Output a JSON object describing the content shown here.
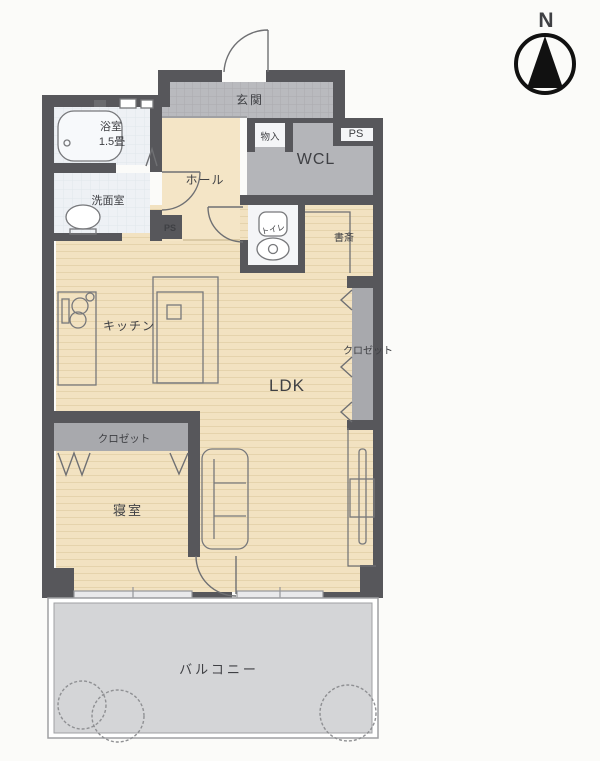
{
  "compass": {
    "label": "N"
  },
  "rooms": {
    "entrance": "玄関",
    "storage": "物入",
    "ps_top": "PS",
    "ps_mid": "PS",
    "wcl": "WCL",
    "hall": "ホール",
    "bathroom": "浴室",
    "bathroom_size": "1.5畳",
    "washroom": "洗面室",
    "toilet": "トイレ",
    "study": "書斎",
    "kitchen": "キッチン",
    "ldk": "LDK",
    "closet_ldk": "クロゼット",
    "closet_bedroom": "クロゼット",
    "bedroom": "寝室",
    "balcony": "バルコニー"
  },
  "colors": {
    "wall": "#57575b",
    "wood_floor": "#f2e2c1",
    "wood_plank_line": "#e5d3ac",
    "hall_floor": "#f4e5c6",
    "entrance_tile": "#b9babe",
    "wcl_floor": "#b4b5b9",
    "closet_floor": "#a8a9ad",
    "bath_floor": "#eef1f5",
    "white_room": "#f4f5f7",
    "balcony_floor": "#d4d5d7",
    "outline": "#6f7073",
    "text": "#3f4044",
    "compass": "#111111"
  }
}
